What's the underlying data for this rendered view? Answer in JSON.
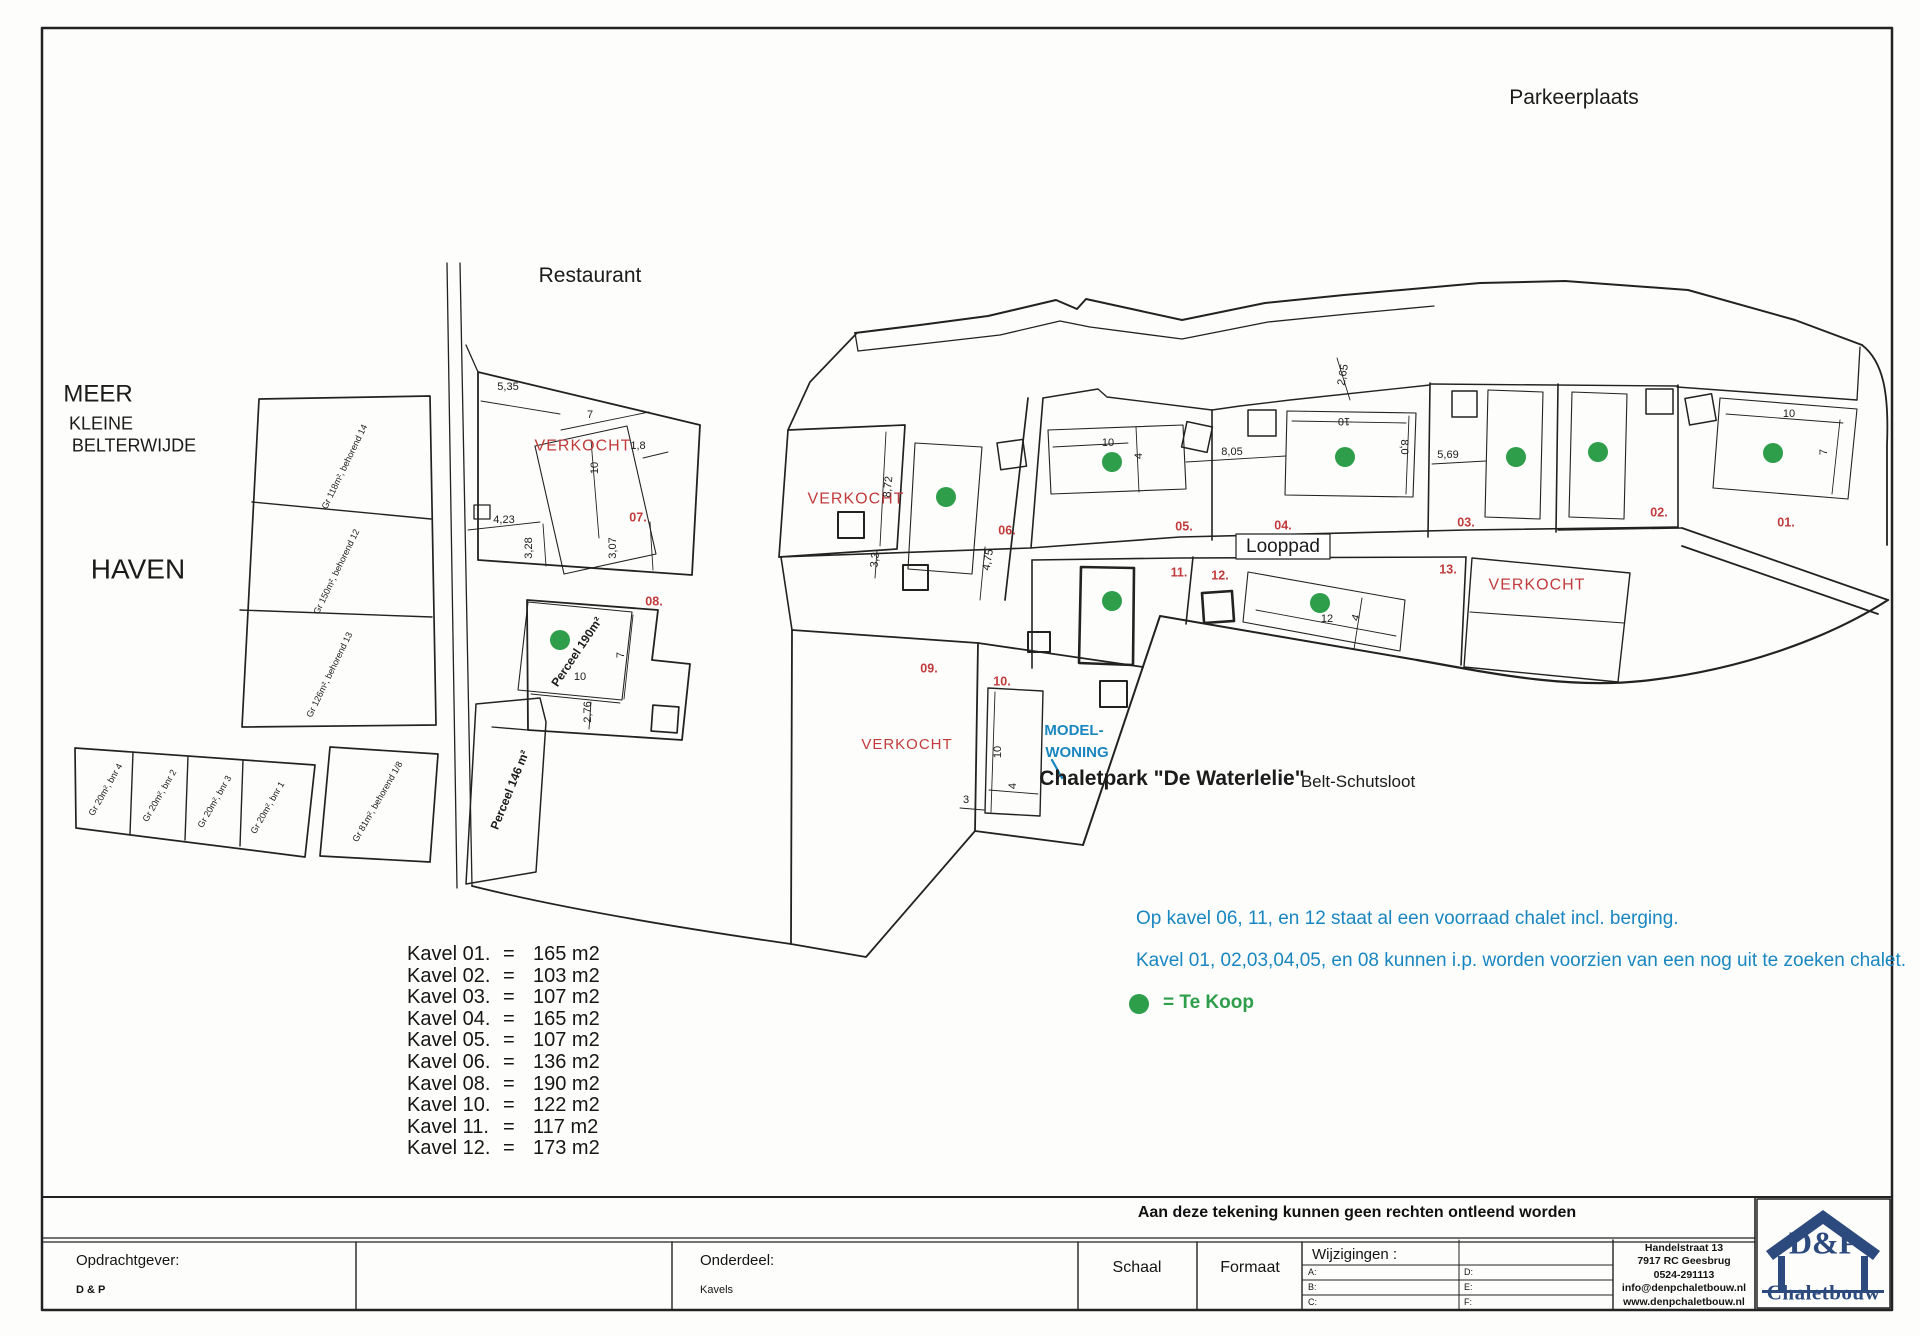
{
  "colors": {
    "ink": "#1b1b1b",
    "red": "#c13b3c",
    "blue": "#1a86c0",
    "green": "#2f9e4b",
    "navy": "#2d4a7e"
  },
  "map": {
    "labels": [
      {
        "n": "parkeerplaats-label",
        "t": "Parkeerplaats",
        "x": 1574,
        "y": 98,
        "s": 21
      },
      {
        "n": "restaurant-label",
        "t": "Restaurant",
        "x": 590,
        "y": 276,
        "s": 21
      },
      {
        "n": "meer-label",
        "t": "MEER",
        "x": 98,
        "y": 394,
        "s": 24
      },
      {
        "n": "kleine-label",
        "t": "KLEINE",
        "x": 101,
        "y": 424,
        "s": 18
      },
      {
        "n": "belterwijde-label",
        "t": "BELTERWIJDE",
        "x": 134,
        "y": 446,
        "s": 18
      },
      {
        "n": "haven-label",
        "t": "HAVEN",
        "x": 138,
        "y": 569,
        "s": 28
      },
      {
        "n": "looppad-label",
        "t": "Looppad",
        "x": 1283,
        "y": 547,
        "s": 19
      },
      {
        "n": "chaletpark-title",
        "t": "Chaletpark \"De Waterlelie\"",
        "x": 1172,
        "y": 779,
        "s": 21,
        "w": 600
      },
      {
        "n": "chaletpark-subtitle",
        "t": "Belt-Schutsloot",
        "x": 1358,
        "y": 782,
        "s": 17
      },
      {
        "n": "verkocht-07",
        "t": "VERKOCHT",
        "x": 583,
        "y": 447,
        "s": 16,
        "c": "r",
        "ls": 1
      },
      {
        "n": "verkocht-06w",
        "t": "VERKOCHT",
        "x": 856,
        "y": 500,
        "s": 16,
        "c": "r",
        "ls": 1
      },
      {
        "n": "verkocht-09",
        "t": "VERKOCHT",
        "x": 907,
        "y": 745,
        "s": 15,
        "c": "r",
        "ls": 1
      },
      {
        "n": "verkocht-13",
        "t": "VERKOCHT",
        "x": 1537,
        "y": 586,
        "s": 16,
        "c": "r",
        "ls": 1
      },
      {
        "n": "plot-01",
        "t": "01.",
        "x": 1786,
        "y": 523,
        "s": 12.5,
        "c": "r",
        "w": 600
      },
      {
        "n": "plot-02",
        "t": "02.",
        "x": 1659,
        "y": 513,
        "s": 12.5,
        "c": "r",
        "w": 600
      },
      {
        "n": "plot-03",
        "t": "03.",
        "x": 1466,
        "y": 523,
        "s": 12.5,
        "c": "r",
        "w": 600
      },
      {
        "n": "plot-04",
        "t": "04.",
        "x": 1283,
        "y": 526,
        "s": 12.5,
        "c": "r",
        "w": 600
      },
      {
        "n": "plot-05",
        "t": "05.",
        "x": 1184,
        "y": 527,
        "s": 12.5,
        "c": "r",
        "w": 600
      },
      {
        "n": "plot-06",
        "t": "06.",
        "x": 1007,
        "y": 531,
        "s": 12.5,
        "c": "r",
        "w": 600
      },
      {
        "n": "plot-07",
        "t": "07.",
        "x": 638,
        "y": 518,
        "s": 12.5,
        "c": "r",
        "w": 600
      },
      {
        "n": "plot-08",
        "t": "08.",
        "x": 654,
        "y": 602,
        "s": 12.5,
        "c": "r",
        "w": 600
      },
      {
        "n": "plot-09",
        "t": "09.",
        "x": 929,
        "y": 669,
        "s": 12.5,
        "c": "r",
        "w": 600
      },
      {
        "n": "plot-10",
        "t": "10.",
        "x": 1002,
        "y": 682,
        "s": 12.5,
        "c": "r",
        "w": 600
      },
      {
        "n": "plot-11",
        "t": "11.",
        "x": 1179,
        "y": 573,
        "s": 12.5,
        "c": "r",
        "w": 600
      },
      {
        "n": "plot-12",
        "t": "12.",
        "x": 1220,
        "y": 576,
        "s": 12.5,
        "c": "r",
        "w": 600
      },
      {
        "n": "plot-13",
        "t": "13.",
        "x": 1448,
        "y": 570,
        "s": 12.5,
        "c": "r",
        "w": 600
      },
      {
        "n": "dim",
        "t": "5,35",
        "x": 508,
        "y": 388,
        "s": 11
      },
      {
        "n": "dim",
        "t": "7",
        "x": 590,
        "y": 416,
        "s": 11
      },
      {
        "n": "dim",
        "t": "1,8",
        "x": 638,
        "y": 447,
        "s": 11
      },
      {
        "n": "dim",
        "t": "10",
        "x": 596,
        "y": 468,
        "s": 11,
        "r": -90
      },
      {
        "n": "dim",
        "t": "4,23",
        "x": 504,
        "y": 521,
        "s": 11
      },
      {
        "n": "dim",
        "t": "3,28",
        "x": 530,
        "y": 548,
        "s": 11,
        "r": -90
      },
      {
        "n": "dim",
        "t": "3,07",
        "x": 614,
        "y": 548,
        "s": 11,
        "r": -90
      },
      {
        "n": "dim",
        "t": "10",
        "x": 580,
        "y": 678,
        "s": 11
      },
      {
        "n": "dim",
        "t": "7",
        "x": 622,
        "y": 655,
        "s": 11,
        "r": -90
      },
      {
        "n": "dim",
        "t": "2,76",
        "x": 589,
        "y": 712,
        "s": 11,
        "r": -90
      },
      {
        "n": "dim",
        "t": "8,72",
        "x": 889,
        "y": 487,
        "s": 11,
        "r": -84
      },
      {
        "n": "dim",
        "t": "3,3",
        "x": 876,
        "y": 560,
        "s": 11,
        "r": -84
      },
      {
        "n": "dim",
        "t": "4,75",
        "x": 989,
        "y": 560,
        "s": 11,
        "r": -80
      },
      {
        "n": "dim",
        "t": "10",
        "x": 1108,
        "y": 444,
        "s": 11
      },
      {
        "n": "dim",
        "t": "4",
        "x": 1140,
        "y": 456,
        "s": 11,
        "r": -90
      },
      {
        "n": "dim",
        "t": "8,05",
        "x": 1232,
        "y": 453,
        "s": 11
      },
      {
        "n": "dim",
        "t": "10",
        "x": 1344,
        "y": 420,
        "s": 11,
        "r": 180
      },
      {
        "n": "dim",
        "t": "8,0",
        "x": 1403,
        "y": 447,
        "s": 11,
        "r": 90
      },
      {
        "n": "dim",
        "t": "5,69",
        "x": 1448,
        "y": 456,
        "s": 11
      },
      {
        "n": "dim",
        "t": "10",
        "x": 1789,
        "y": 415,
        "s": 11
      },
      {
        "n": "dim",
        "t": "7",
        "x": 1825,
        "y": 452,
        "s": 11,
        "r": -90
      },
      {
        "n": "dim",
        "t": "2,65",
        "x": 1344,
        "y": 375,
        "s": 11,
        "r": -80
      },
      {
        "n": "dim",
        "t": "12",
        "x": 1327,
        "y": 620,
        "s": 11
      },
      {
        "n": "dim",
        "t": "4",
        "x": 1357,
        "y": 618,
        "s": 11,
        "r": -72
      },
      {
        "n": "dim",
        "t": "10",
        "x": 999,
        "y": 752,
        "s": 11,
        "r": -90
      },
      {
        "n": "dim",
        "t": "4",
        "x": 1014,
        "y": 786,
        "s": 11,
        "r": -90
      },
      {
        "n": "dim",
        "t": "3",
        "x": 966,
        "y": 801,
        "s": 11
      },
      {
        "n": "parcel-note",
        "t": "Gr 118m², behorend 14",
        "x": 345,
        "y": 467,
        "s": 9,
        "r": -64
      },
      {
        "n": "parcel-note",
        "t": "Gr 150m², behorend 12",
        "x": 337,
        "y": 572,
        "s": 9,
        "r": -64
      },
      {
        "n": "parcel-note",
        "t": "Gr 126m², behorend 13",
        "x": 330,
        "y": 675,
        "s": 9,
        "r": -64
      },
      {
        "n": "parcel-note",
        "t": "Gr 20m², bnr 4",
        "x": 106,
        "y": 790,
        "s": 9,
        "r": -60
      },
      {
        "n": "parcel-note",
        "t": "Gr 20m², bnr 2",
        "x": 160,
        "y": 796,
        "s": 9,
        "r": -60
      },
      {
        "n": "parcel-note",
        "t": "Gr 20m², bnr 3",
        "x": 215,
        "y": 802,
        "s": 9,
        "r": -60
      },
      {
        "n": "parcel-note",
        "t": "Gr 20m², bnr 1",
        "x": 268,
        "y": 808,
        "s": 9,
        "r": -60
      },
      {
        "n": "parcel-note",
        "t": "Gr 81m², behorend 1/8",
        "x": 378,
        "y": 802,
        "s": 9,
        "r": -60
      },
      {
        "n": "perceel-190-label",
        "t": "Perceel 190m²",
        "x": 577,
        "y": 652,
        "s": 12,
        "w": 600,
        "r": -56
      },
      {
        "n": "perceel-146-label",
        "t": "Perceel 146 m²",
        "x": 510,
        "y": 790,
        "s": 12,
        "w": 600,
        "r": -68
      },
      {
        "n": "modelwoning-label-1",
        "t": "MODEL-",
        "x": 1074,
        "y": 731,
        "s": 15,
        "c": "b",
        "w": 700
      },
      {
        "n": "modelwoning-label-2",
        "t": "WONING",
        "x": 1077,
        "y": 753,
        "s": 15,
        "c": "b",
        "w": 700
      }
    ],
    "te_koop_dots": [
      {
        "x": 560,
        "y": 640
      },
      {
        "x": 946,
        "y": 497
      },
      {
        "x": 1112,
        "y": 462
      },
      {
        "x": 1345,
        "y": 457
      },
      {
        "x": 1516,
        "y": 457
      },
      {
        "x": 1598,
        "y": 452
      },
      {
        "x": 1773,
        "y": 453
      },
      {
        "x": 1112,
        "y": 601
      },
      {
        "x": 1320,
        "y": 603
      }
    ]
  },
  "notes": {
    "line1": "Op kavel 06, 11, en 12 staat al een voorraad chalet incl. berging.",
    "line2": "Kavel 01, 02,03,04,05, en 08 kunnen i.p. worden voorzien van een nog uit te zoeken chalet."
  },
  "legend": {
    "text": "= Te Koop"
  },
  "kavel_list": {
    "rows": [
      {
        "label": "Kavel 01.",
        "eq": "=",
        "value": "165 m2"
      },
      {
        "label": "Kavel 02.",
        "eq": "=",
        "value": "103 m2"
      },
      {
        "label": "Kavel 03.",
        "eq": "=",
        "value": "107 m2"
      },
      {
        "label": "Kavel 04.",
        "eq": "=",
        "value": "165 m2"
      },
      {
        "label": "Kavel 05.",
        "eq": "=",
        "value": "107 m2"
      },
      {
        "label": "Kavel 06.",
        "eq": "=",
        "value": "136 m2"
      },
      {
        "label": "Kavel 08.",
        "eq": "=",
        "value": "190 m2"
      },
      {
        "label": "Kavel 10.",
        "eq": "=",
        "value": "122 m2"
      },
      {
        "label": "Kavel 11.",
        "eq": "=",
        "value": "117 m2"
      },
      {
        "label": "Kavel 12.",
        "eq": "=",
        "value": "173 m2"
      }
    ]
  },
  "disclaimer": "Aan deze tekening kunnen geen rechten ontleend worden",
  "title_block": {
    "opdrachtgever_label": "Opdrachtgever:",
    "opdrachtgever_value": "D & P",
    "onderdeel_label": "Onderdeel:",
    "onderdeel_value": "Kavels",
    "schaal_label": "Schaal",
    "formaat_label": "Formaat",
    "wijzigingen_label": "Wijzigingen :",
    "wijzigingen_left": [
      "A:",
      "B:",
      "C:"
    ],
    "wijzigingen_right": [
      "D:",
      "E:",
      "F:"
    ],
    "address_lines": [
      "Handelstraat 13",
      "7917 RC Geesbrug",
      "0524-291113",
      "info@denpchaletbouw.nl",
      "www.denpchaletbouw.nl"
    ],
    "logo_top": "D&P",
    "logo_bottom": "Chaletbouw"
  }
}
